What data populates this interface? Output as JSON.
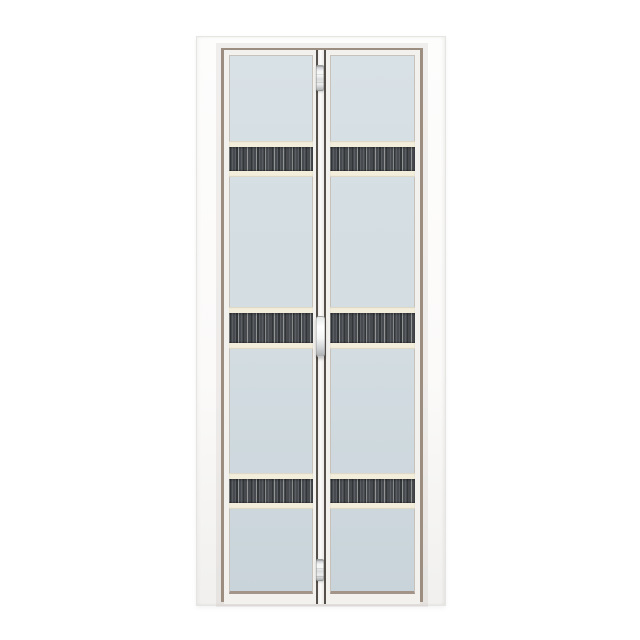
{
  "scene": {
    "description": "Product photo of a white aluminium bi-fold door with two folding leaves, frosted glass panels and three dark wood-grain decorative bands, centered on a plain white background",
    "background_color": "#ffffff",
    "colors": {
      "background": "#ffffff",
      "frame_light": "#fdfdfc",
      "frame_mid": "#f1f0ee",
      "trim_taupe": "#9c8d81",
      "leaf_white": "#f2f1ee",
      "glass_light": "#d8e1e5",
      "glass_dark": "#c9d4da",
      "glass_edge": "#c6c1ba",
      "glass_edge_bottom": "#a29488",
      "band_cream": "#f3eddc",
      "band_dark": "#474b4f",
      "band_streak": "#c9ccc7",
      "joint_line": "#56504a",
      "metal_light": "#f2f3f4",
      "metal_dark": "#b3b6b8"
    },
    "door": {
      "type": "bi-fold",
      "leaf_count": 2,
      "glass_finish": "frosted",
      "decorative_band_count": 3,
      "band_texture": "dark charcoal with vertical wood-grain streaks"
    },
    "bands": [
      {
        "top": 85,
        "dark_height": 24
      },
      {
        "top": 251,
        "dark_height": 30
      },
      {
        "top": 417,
        "dark_height": 24
      }
    ],
    "hardware": [
      {
        "kind": "hinge",
        "name": "hinge-top",
        "top": 15,
        "height": 26
      },
      {
        "kind": "handle",
        "name": "door-handle",
        "top": 266,
        "height": 41
      },
      {
        "kind": "hinge",
        "name": "hinge-bottom",
        "top": 509,
        "height": 22
      }
    ]
  }
}
